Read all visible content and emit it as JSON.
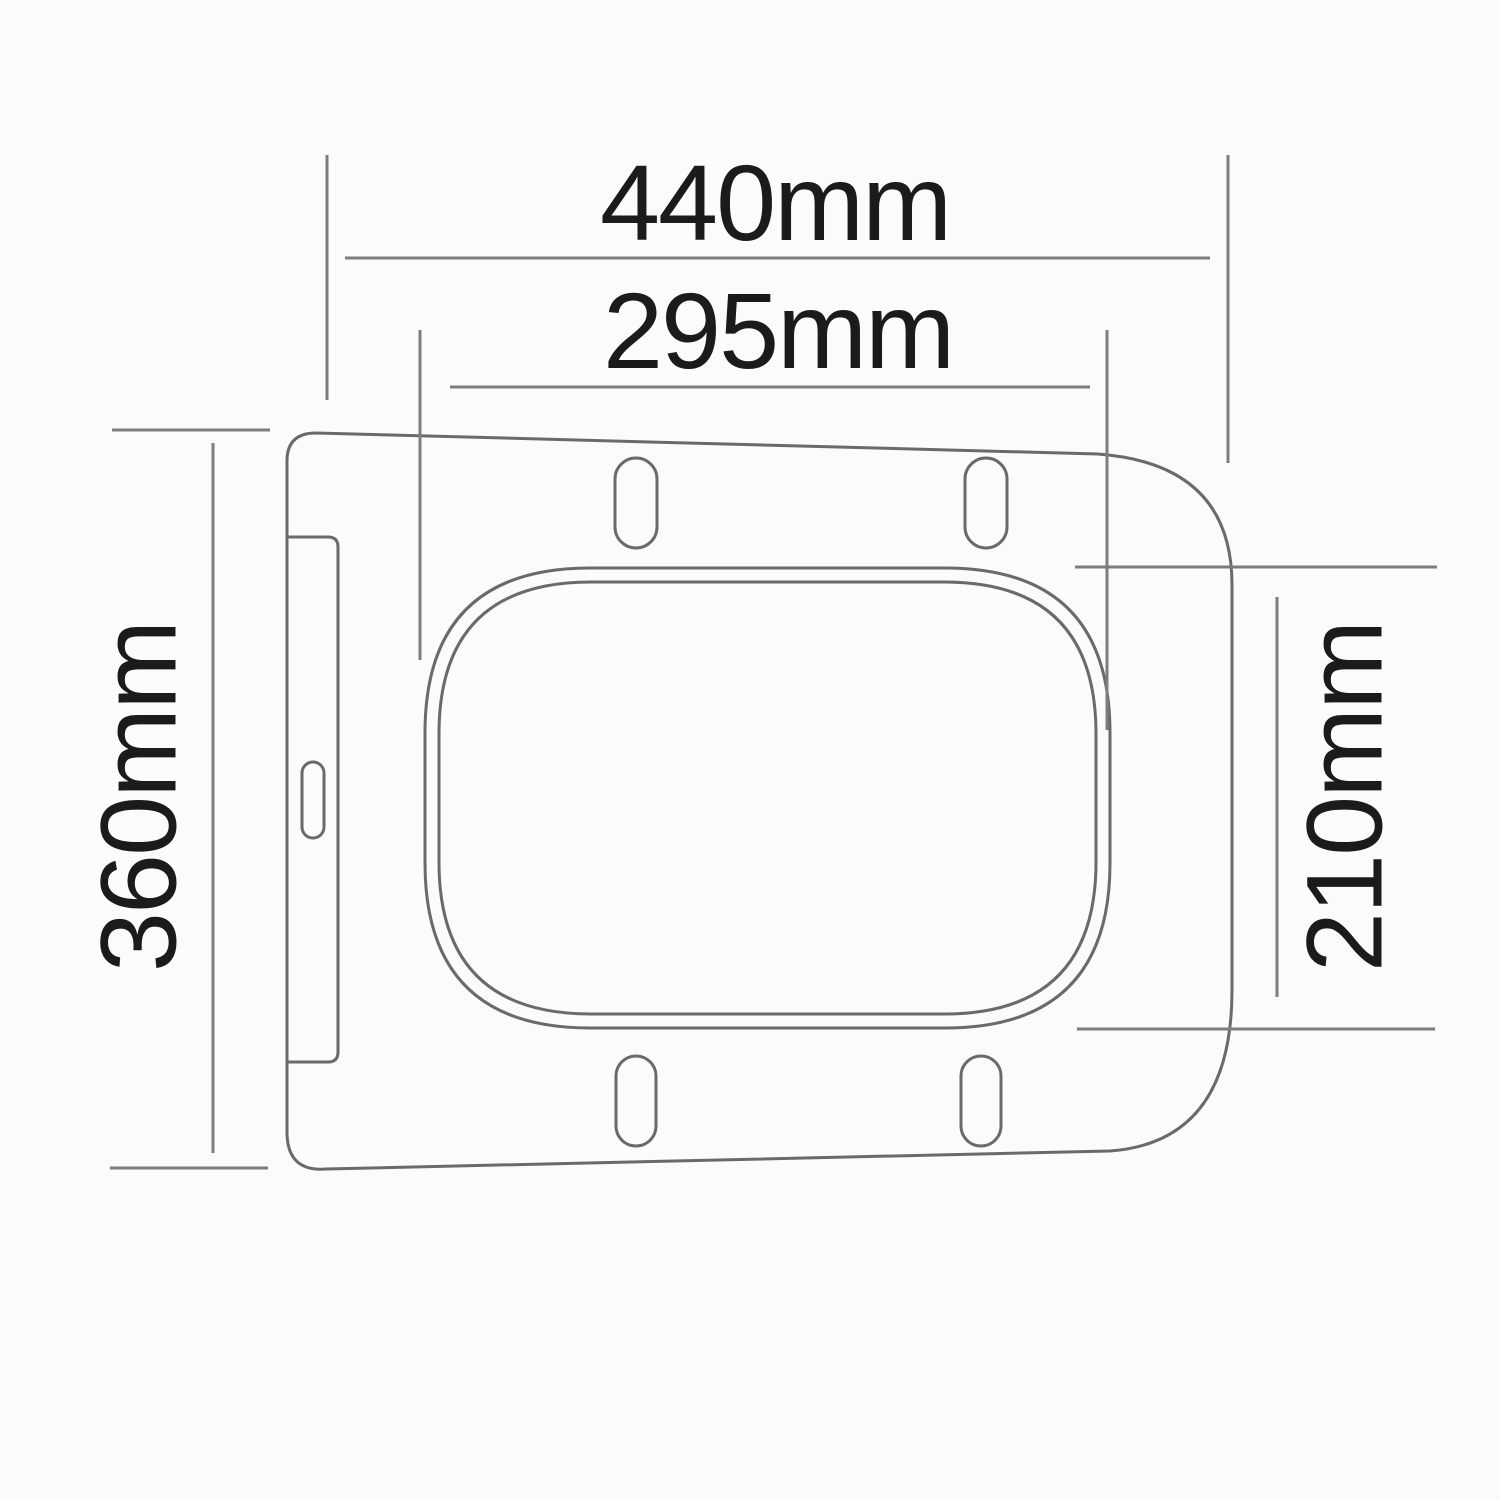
{
  "title": "Toilet seat top-view dimension drawing",
  "drawing": {
    "labels": {
      "overall_width": "440mm",
      "opening_width": "295mm",
      "overall_depth": "360mm",
      "opening_depth": "210mm"
    },
    "colors": {
      "outline": "#6a6a6a",
      "dimension": "#7d7d7d",
      "text": "#1b1b1b",
      "background": "#fbfbfb"
    }
  }
}
